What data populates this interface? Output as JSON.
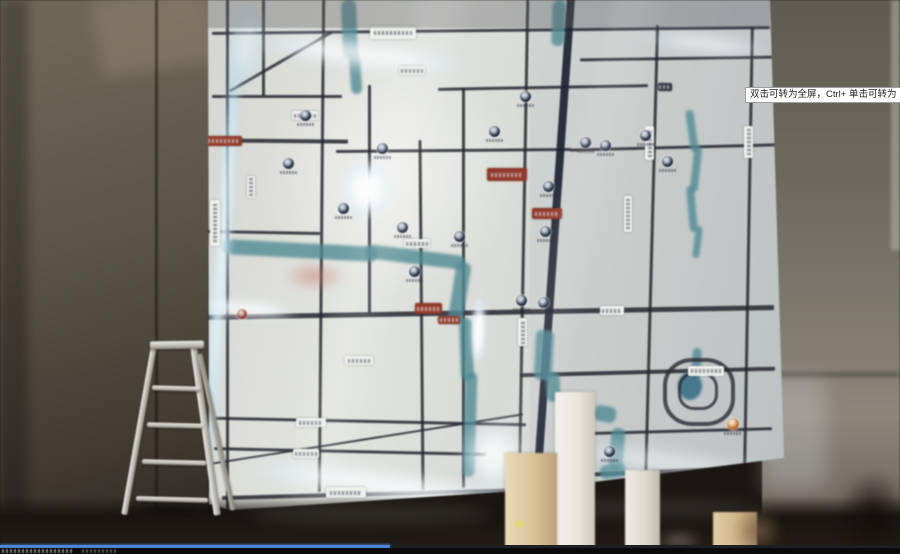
{
  "video_player": {
    "tooltip_text": "双击可转为全屏，Ctrl+ 单击可转为",
    "progress_fraction": 0.433
  },
  "icons": {
    "poi_marker_icon": "filled-circle-badge",
    "ring_road_icon": "concentric-rounded-rings",
    "ladder_icon": "a-frame-step-ladder"
  },
  "colors": {
    "tooltip_bg": "#ffffff",
    "tooltip_border": "#9e9e9e",
    "tooltip_text": "#1f1f1f",
    "progress_blue": "#4a86d8",
    "progress_track": "#1d1f22",
    "bottom_bar": "#0a0a0a",
    "map_glow_white": "#ffffff",
    "river_teal": "#4d8b96",
    "lake_blue": "#2e6a86",
    "road_dark": "#23252e",
    "road_main": "#1a2030",
    "poi_navy": "#1c2a3e",
    "poi_orange": "#c06a28",
    "poi_red": "#8a3226",
    "badge_white": "#f2f4f0",
    "badge_red": "#96382a"
  }
}
